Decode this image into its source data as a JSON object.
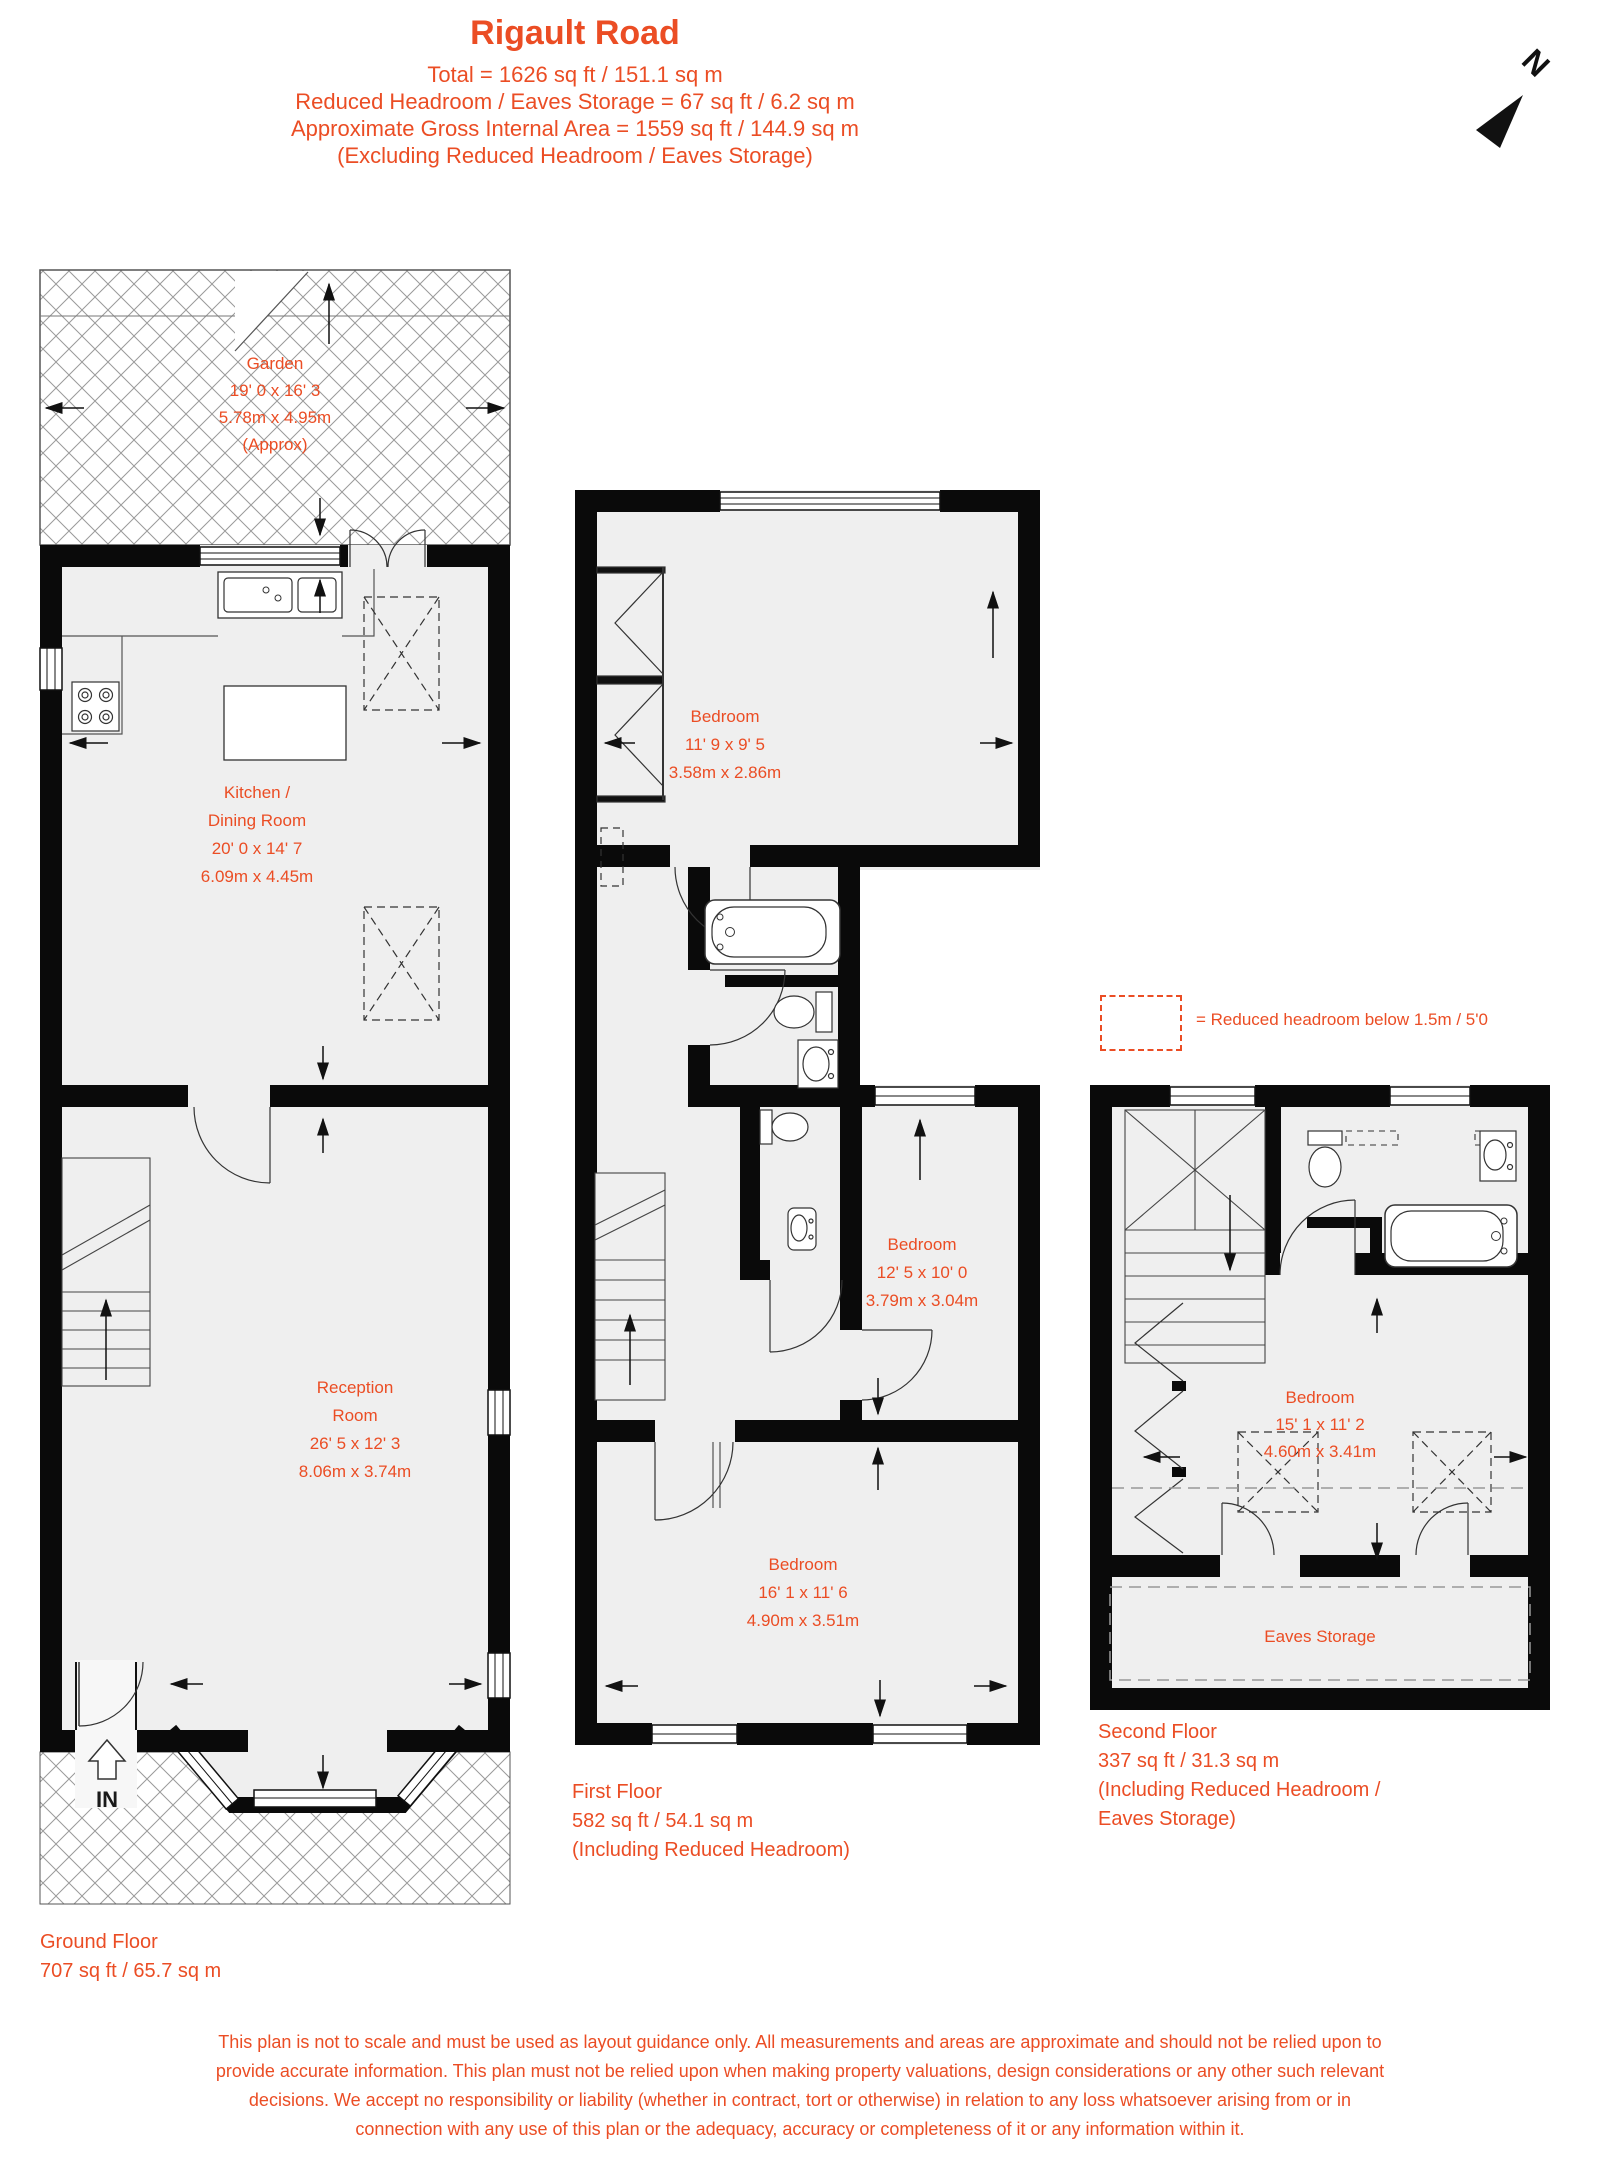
{
  "header": {
    "title": "Rigault Road",
    "lines": [
      "Total = 1626 sq ft / 151.1 sq m",
      "Reduced Headroom / Eaves Storage = 67 sq ft / 6.2 sq m",
      "Approximate Gross Internal Area = 1559 sq ft / 144.9 sq m",
      "(Excluding Reduced Headroom / Eaves Storage)"
    ]
  },
  "north": {
    "label": "N"
  },
  "legend": {
    "text": "= Reduced headroom below 1.5m / 5'0"
  },
  "colors": {
    "accent": "#EB4D24",
    "wall": "#0a0a0a",
    "room_fill": "#efefef"
  },
  "ground": {
    "garden": {
      "lines": [
        "Garden",
        "19' 0 x 16' 3",
        "5.78m x 4.95m",
        "(Approx)"
      ]
    },
    "kitchen": {
      "lines": [
        "Kitchen /",
        "Dining Room",
        "20' 0 x 14' 7",
        "6.09m x 4.45m"
      ]
    },
    "reception": {
      "lines": [
        "Reception",
        "Room",
        "26' 5 x 12' 3",
        "8.06m x 3.74m"
      ]
    },
    "entrance": "IN",
    "label": {
      "lines": [
        "Ground Floor",
        "707 sq ft / 65.7 sq m"
      ]
    }
  },
  "first": {
    "bedroom_top": {
      "lines": [
        "Bedroom",
        "11' 9 x 9' 5",
        "3.58m x 2.86m"
      ]
    },
    "bedroom_mid": {
      "lines": [
        "Bedroom",
        "12' 5 x 10' 0",
        "3.79m x 3.04m"
      ]
    },
    "bedroom_bottom": {
      "lines": [
        "Bedroom",
        "16' 1 x 11' 6",
        "4.90m x 3.51m"
      ]
    },
    "label": {
      "lines": [
        "First Floor",
        "582 sq ft / 54.1 sq m",
        "(Including Reduced Headroom)"
      ]
    }
  },
  "second": {
    "bedroom": {
      "lines": [
        "Bedroom",
        "15' 1 x 11' 2",
        "4.60m x 3.41m"
      ]
    },
    "eaves": "Eaves Storage",
    "label": {
      "lines": [
        "Second Floor",
        "337 sq ft / 31.3 sq m",
        "(Including Reduced Headroom /",
        "Eaves Storage)"
      ]
    }
  },
  "disclaimer": {
    "lines": [
      "This plan is not to scale and must be used as layout guidance only. All measurements and areas are approximate and should not be relied upon to",
      "provide accurate information. This plan must not be relied upon when making property valuations, design considerations or any other such relevant",
      "decisions. We accept no responsibility or liability (whether in contract, tort or otherwise) in relation to any loss whatsoever arising from or in",
      "connection with any use of this plan or the adequacy, accuracy or completeness of it or any information within it."
    ]
  }
}
